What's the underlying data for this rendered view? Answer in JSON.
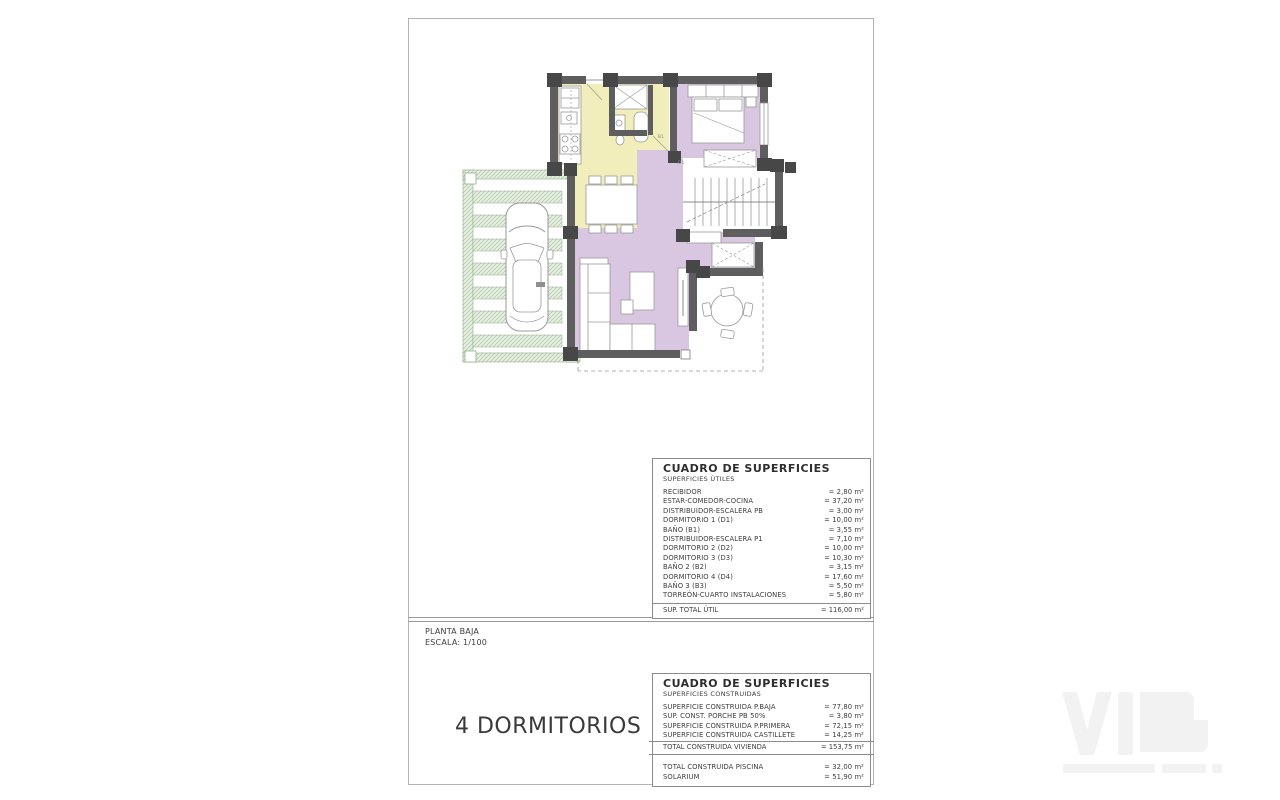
{
  "plan": {
    "labels": {
      "bath1": "B1",
      "dorm1": "D1"
    },
    "colors": {
      "wall": "#5e5e5e",
      "post": "#474747",
      "kitchen": "#f1eebb",
      "rooms": "#d9c7e1",
      "pergola": "#e7efe3",
      "pergola_line": "#a9c3a3"
    }
  },
  "title_block": {
    "plan_name": "PLANTA BAJA",
    "scale": "ESCALA: 1/100",
    "headline": "4 DORMITORIOS"
  },
  "tables": {
    "utiles": {
      "title": "CUADRO DE SUPERFICIES",
      "subtitle": "SUPERFICIES ÚTILES",
      "rows": [
        {
          "label": "RECIBIDOR",
          "value": "= 2,80 m²"
        },
        {
          "label": "ESTAR-COMEDOR-COCINA",
          "value": "= 37,20 m²"
        },
        {
          "label": "DISTRIBUIDOR-ESCALERA PB",
          "value": "= 3,00 m²"
        },
        {
          "label": "DORMITORIO 1 (D1)",
          "value": "= 10,00 m²"
        },
        {
          "label": "BAÑO  (B1)",
          "value": "= 3,55 m²"
        },
        {
          "label": "DISTRIBUIDOR-ESCALERA P1",
          "value": "= 7,10 m²"
        },
        {
          "label": "DORMITORIO 2 (D2)",
          "value": "= 10,00 m²"
        },
        {
          "label": "DORMITORIO 3 (D3)",
          "value": "= 10,30 m²"
        },
        {
          "label": "BAÑO 2 (B2)",
          "value": "= 3,15 m²"
        },
        {
          "label": "DORMITORIO 4 (D4)",
          "value": "= 17,60 m²"
        },
        {
          "label": "BAÑO 3 (B3)",
          "value": "= 5,50 m²"
        },
        {
          "label": "TORREÓN-CUARTO INSTALACIONES",
          "value": "= 5,80 m²"
        }
      ],
      "total": {
        "label": "SUP. TOTAL ÚTIL",
        "value": "= 116,00 m²"
      }
    },
    "construidas": {
      "title": "CUADRO DE SUPERFICIES",
      "subtitle": "SUPERFICIES CONSTRUIDAS",
      "rows": [
        {
          "label": "SUPERFICIE  CONSTRUIDA P.BAJA",
          "value": "= 77,80 m²"
        },
        {
          "label": "SUP. CONST. PORCHE PB 50%",
          "value": "= 3,80 m²"
        },
        {
          "label": "SUPERFICIE CONSTRUIDA P.PRIMERA",
          "value": "= 72,15 m²"
        },
        {
          "label": "SUPERFICIE CONSTRUIDA CASTILLETE",
          "value": "= 14,25 m²"
        }
      ],
      "total": {
        "label": "TOTAL CONSTRUIDA VIVIENDA",
        "value": "= 153,75 m²"
      },
      "extra_rows": [
        {
          "label": "TOTAL CONSTRUIDA PISCINA",
          "value": "= 32,00 m²"
        },
        {
          "label": "SOLARIUM",
          "value": "= 51,90 m²"
        }
      ]
    }
  },
  "watermark": {
    "color": "#f2f2f2"
  }
}
